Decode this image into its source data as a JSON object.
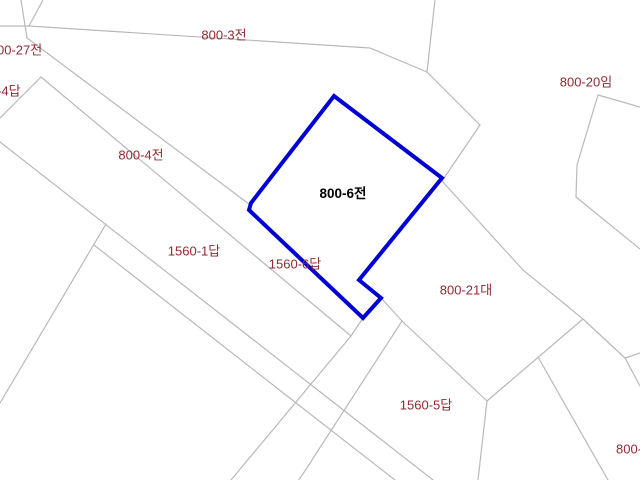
{
  "map": {
    "type": "cadastral-parcel-map",
    "background_color": "#ffffff",
    "boundary_color": "#b9b9b9",
    "label_color": "#8e2b31",
    "highlighted_parcel": {
      "id": "800-6전",
      "outline_color": "#0000d2"
    },
    "labels": [
      {
        "text": "800-3전"
      },
      {
        "text": "800-27전"
      },
      {
        "text": "800-4답"
      },
      {
        "text": "800-4전"
      },
      {
        "text": "800-6전"
      },
      {
        "text": "800-20임"
      },
      {
        "text": "1560-1답"
      },
      {
        "text": "1560-6답"
      },
      {
        "text": "800-21대"
      },
      {
        "text": "1560-5답"
      },
      {
        "text": "800-"
      }
    ]
  }
}
